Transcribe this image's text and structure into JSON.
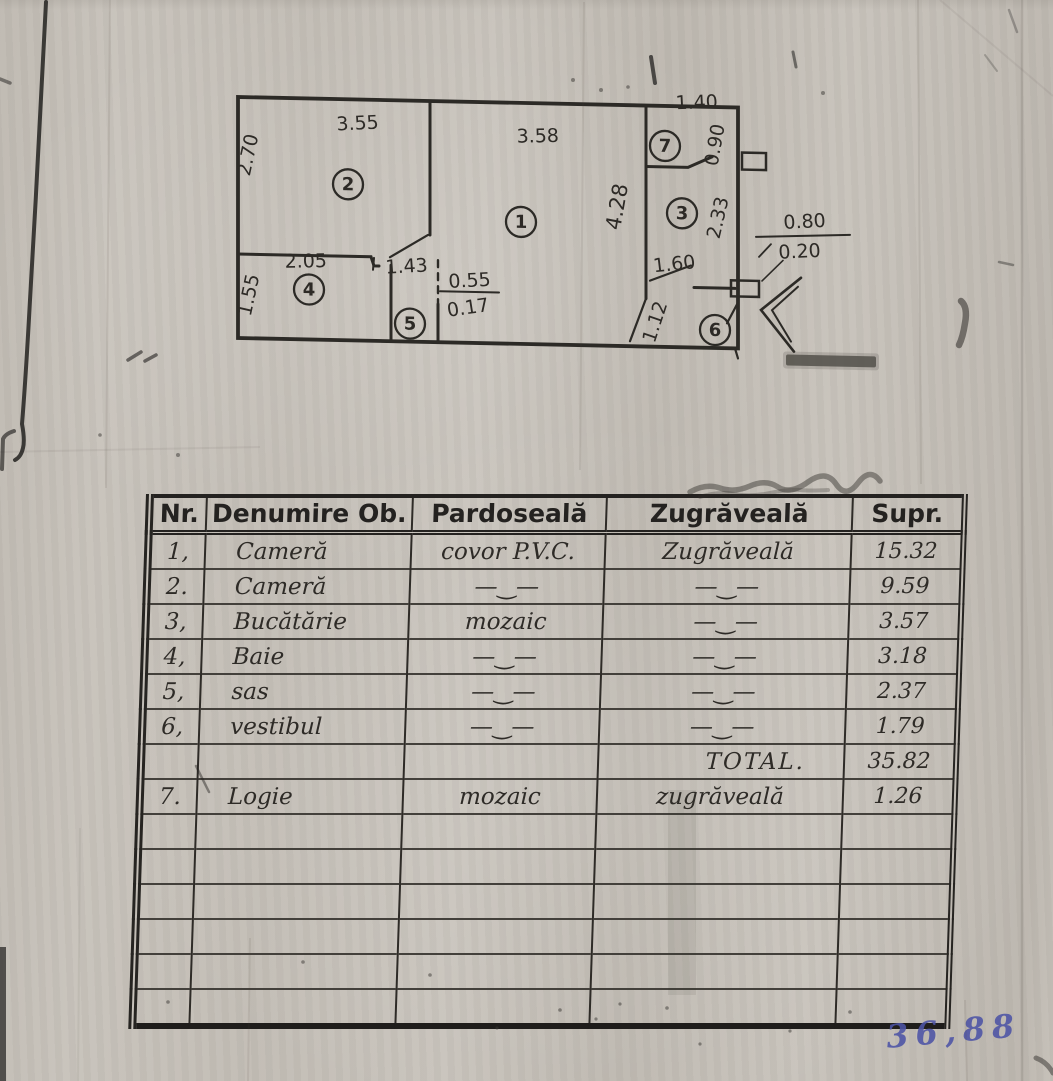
{
  "plan": {
    "rooms": [
      {
        "label": "1"
      },
      {
        "label": "2"
      },
      {
        "label": "3"
      },
      {
        "label": "4"
      },
      {
        "label": "5"
      },
      {
        "label": "6"
      },
      {
        "label": "7"
      }
    ],
    "dims": [
      {
        "label": "3.55"
      },
      {
        "label": "2.70"
      },
      {
        "label": "3.58"
      },
      {
        "label": "1.40"
      },
      {
        "label": "0.90"
      },
      {
        "label": "4.28"
      },
      {
        "label": "2.33"
      },
      {
        "label": "1.60"
      },
      {
        "label": "1.12"
      },
      {
        "label": "2.05"
      },
      {
        "label": "1.55"
      },
      {
        "label": "1.43"
      },
      {
        "label": "0.55"
      },
      {
        "label": "0.17"
      },
      {
        "label": "0.80"
      },
      {
        "label": "0.20"
      }
    ]
  },
  "table": {
    "headers": [
      "Nr.",
      "Denumire Ob.",
      "Pardoseală",
      "Zugrăveală",
      "Supr."
    ],
    "rows": [
      {
        "cells": [
          "1,",
          "Cameră",
          "covor P.V.C.",
          "Zugrăveală",
          "15.32"
        ]
      },
      {
        "cells": [
          "2.",
          "Cameră",
          "—‿—",
          "—‿—",
          "9.59"
        ]
      },
      {
        "cells": [
          "3,",
          "Bucătărie",
          "mozaic",
          "—‿—",
          "3.57"
        ]
      },
      {
        "cells": [
          "4,",
          "Baie",
          "—‿—",
          "—‿—",
          "3.18"
        ]
      },
      {
        "cells": [
          "5,",
          "sas",
          "—‿—",
          "—‿—",
          "2.37"
        ]
      },
      {
        "cells": [
          "6,",
          "vestibul",
          "—‿—",
          "—‿—",
          "1.79"
        ]
      },
      {
        "cells": [
          "",
          "",
          "",
          "TOTAL.",
          "35.82"
        ]
      },
      {
        "cells": [
          "7.",
          "Logie",
          "mozaic",
          "zugrăveală",
          "1.26"
        ]
      },
      {
        "cells": [
          "",
          "",
          "",
          "",
          ""
        ]
      },
      {
        "cells": [
          "",
          "",
          "",
          "",
          ""
        ]
      },
      {
        "cells": [
          "",
          "",
          "",
          "",
          ""
        ]
      },
      {
        "cells": [
          "",
          "",
          "",
          "",
          ""
        ]
      },
      {
        "cells": [
          "",
          "",
          "",
          "",
          ""
        ]
      },
      {
        "cells": [
          "",
          "",
          "",
          "",
          ""
        ]
      }
    ]
  },
  "note": {
    "value": "36,88"
  }
}
